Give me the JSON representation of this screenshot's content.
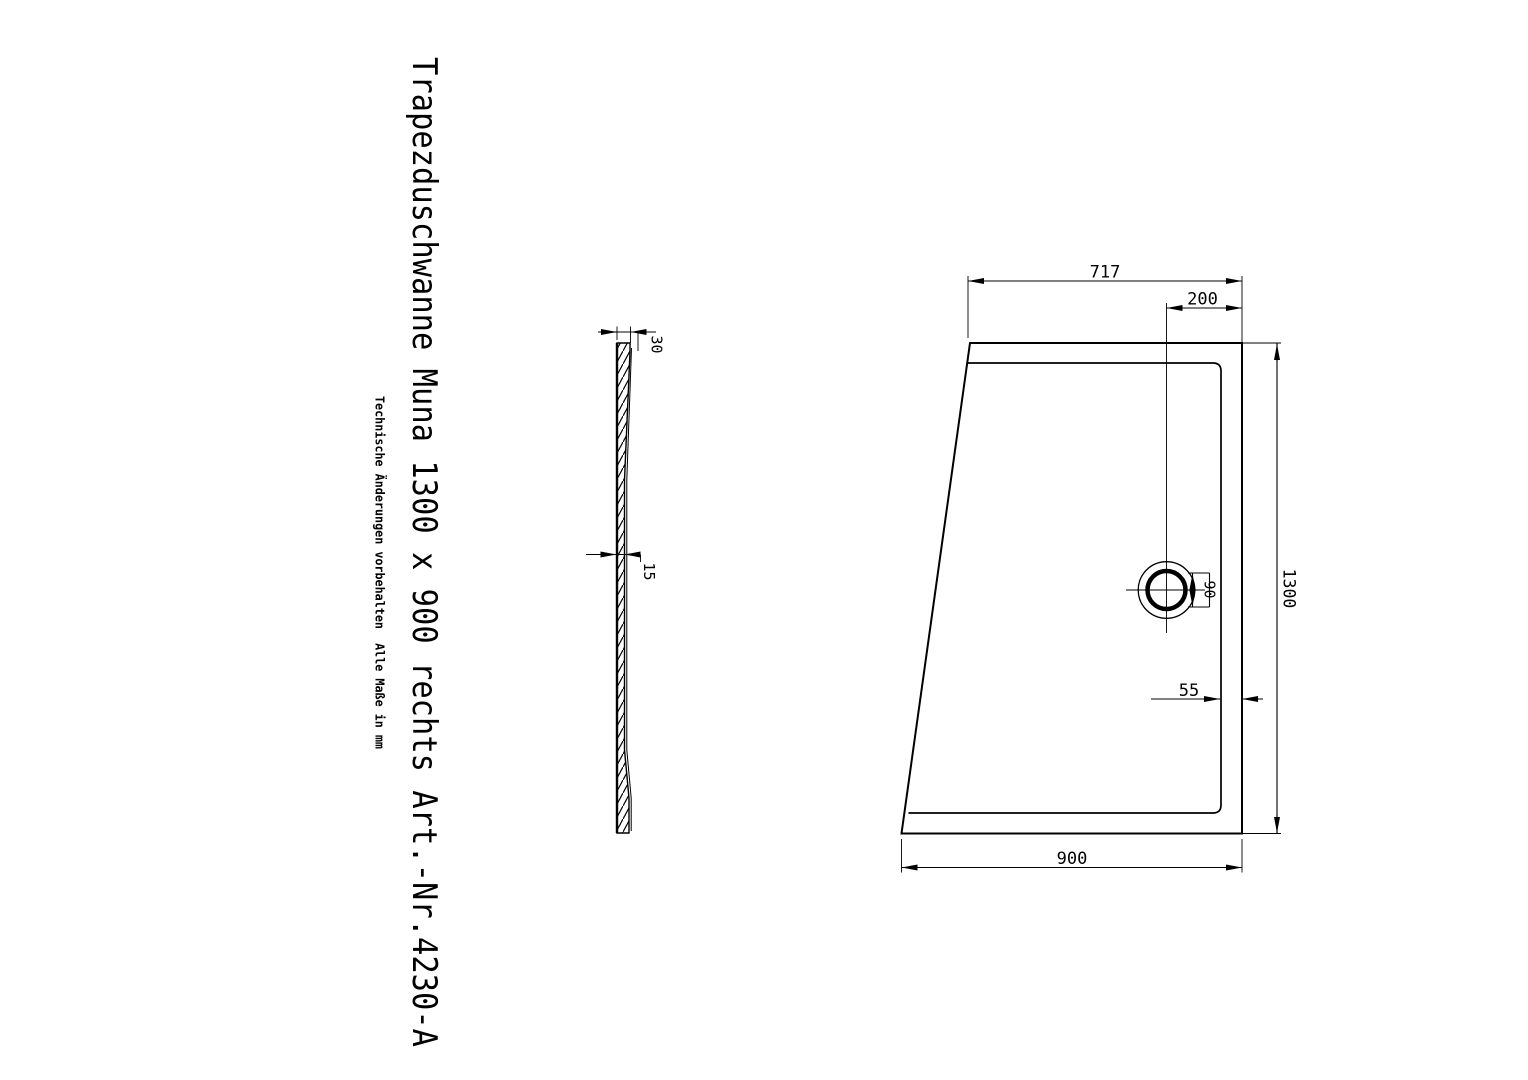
{
  "drawing": {
    "title": "Trapezduschwanne Muna 1300 x 900 rechts Art.-Nr.4230-A",
    "disclaimer": "Technische Änderungen vorbehalten  Alle Maße in mm"
  },
  "side_view": {
    "rim_thickness": "30",
    "wall_thickness": "15"
  },
  "top_view": {
    "top_width": "717",
    "drain_offset_right": "200",
    "length": "1300",
    "drain_diameter": "90",
    "rim_edge_gap": "55",
    "bottom_width": "900"
  },
  "colors": {
    "line": "#000000",
    "background": "#ffffff"
  }
}
